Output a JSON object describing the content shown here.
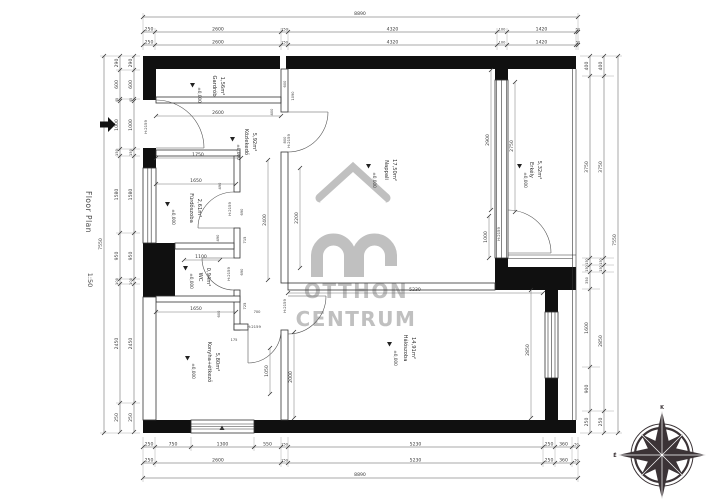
{
  "meta": {
    "floor_plan_label": "Floor Plan",
    "scale_label": "1:50",
    "level": "±0,000",
    "door_head": "H:2159",
    "overall_width": "8890",
    "overall_height": "7550"
  },
  "watermark": {
    "line1": "OTTHON",
    "line2": "CENTRUM",
    "color": "#c0c0c0"
  },
  "rooms": {
    "gardrob": {
      "name": "Gardrób",
      "area": "1,56m²"
    },
    "kozlekedo": {
      "name": "Közlekedő",
      "area": "5,92m²"
    },
    "furdoszoba": {
      "name": "Fürdőszoba",
      "area": "2,61m²"
    },
    "wc": {
      "name": "WC",
      "area": "0,94m²"
    },
    "konyha": {
      "name": "Konyha+étkező",
      "area": "5,80m²"
    },
    "nappali": {
      "name": "Nappali",
      "area": "17,50m²"
    },
    "erkely": {
      "name": "Erkély",
      "area": "5,32m²"
    },
    "haloszoba": {
      "name": "Hálószoba",
      "area": "14,91m²"
    }
  },
  "dims": {
    "top": [
      "250",
      "2600",
      "150",
      "4320",
      "100",
      "1420",
      "50"
    ],
    "bottom_a": [
      "250",
      "750",
      "1300",
      "550",
      "150",
      "5230",
      "250",
      "360",
      "50"
    ],
    "bottom_b": [
      "250",
      "2600",
      "150",
      "5230",
      "250",
      "360",
      "50"
    ],
    "left": [
      "290",
      "600",
      "45",
      "1000",
      "150",
      "1580",
      "950",
      "100",
      "2450",
      "250"
    ],
    "right_a": [
      "400",
      "3750",
      "150",
      "150",
      "350",
      "1600",
      "900",
      "250"
    ],
    "right_b": [
      "400",
      "3750",
      "150",
      "150",
      "2850",
      "250"
    ],
    "interior": {
      "gardrob_width": "2600",
      "gardrob_depth": "600",
      "wall_400": "400",
      "win_1090": "1090",
      "door_800": "800",
      "hall_1750": "1750",
      "bath_1650": "1650",
      "bath_490a": "490",
      "bath_690a": "690",
      "bath_490b": "490",
      "bath_715": "715",
      "corr_2400": "2400",
      "nap_2200": "2200",
      "wc_1100": "1100",
      "wc_690": "690",
      "kit_725": "725",
      "kit_600": "600",
      "kit_700": "700",
      "kit_175": "175",
      "kit_1650": "1650",
      "kit_1050": "1050",
      "kit_2000": "2000",
      "nap_5230": "5230",
      "erk_2900": "2900",
      "erk_2750": "2750",
      "erk_1000": "1000",
      "bed_2850": "2850"
    }
  },
  "compass": {
    "top": "K",
    "right": "D",
    "bottom": "Ny",
    "left": "É"
  }
}
